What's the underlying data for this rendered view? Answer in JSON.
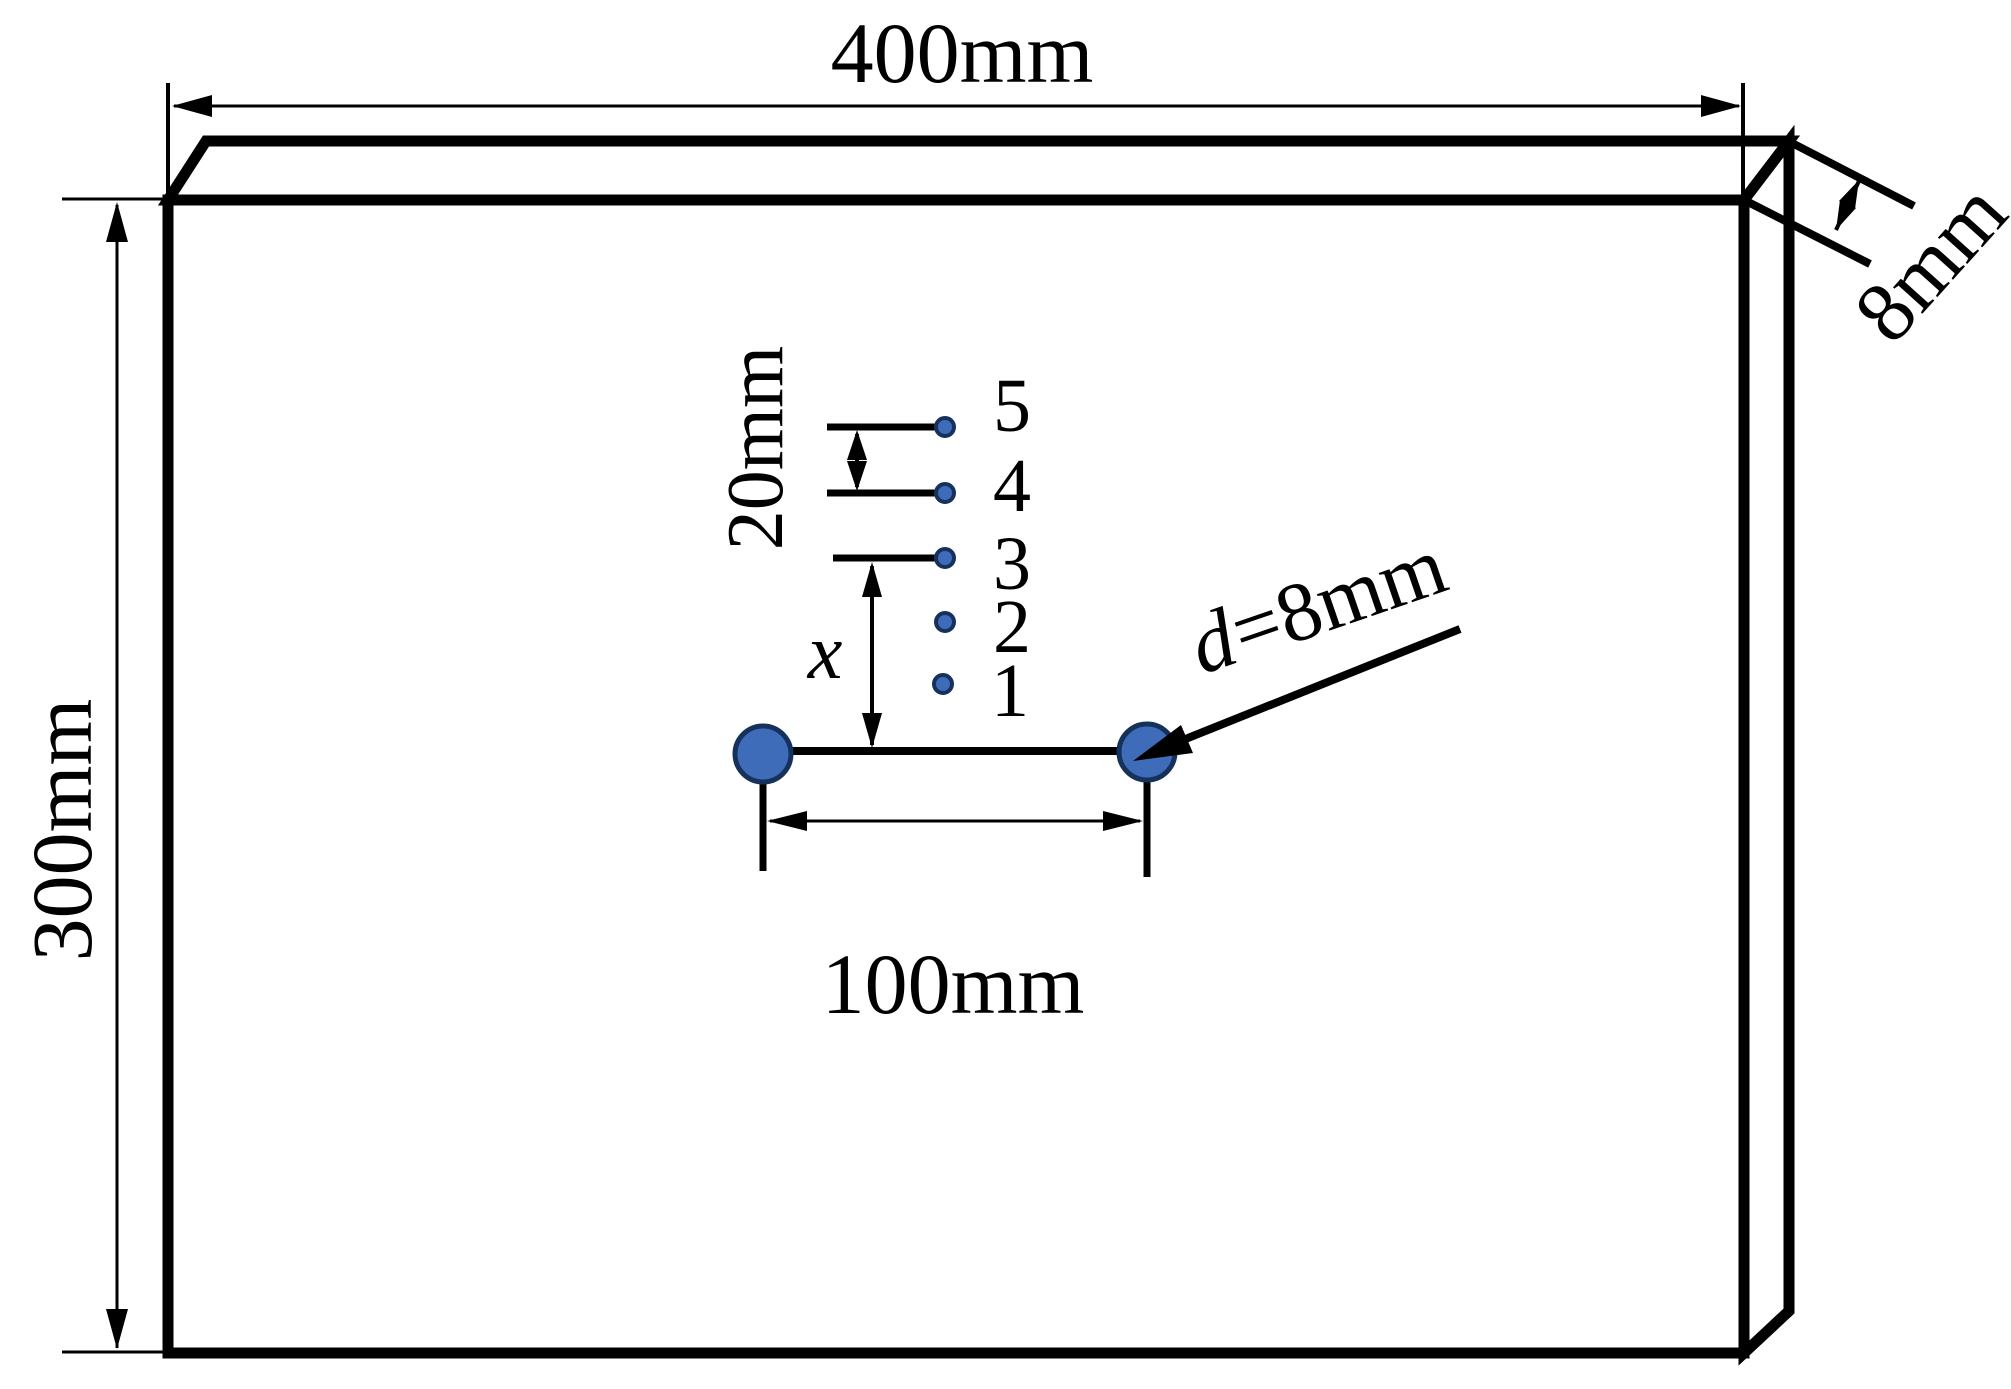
{
  "figure": {
    "plate_width_label": "400mm",
    "plate_height_label": "300mm",
    "plate_thickness_label": "8mm",
    "point_spacing_label": "20mm",
    "point_offset_label": "x",
    "hole_spacing_label": "100mm",
    "hole_diameter_symbol": "d",
    "hole_diameter_value": "=8mm",
    "point_labels": [
      "5",
      "4",
      "3",
      "2",
      "1"
    ]
  },
  "colors": {
    "marker_fill": "#3E6CB9",
    "marker_stroke": "#16325C",
    "line": "#000000",
    "background": "#FFFFFF"
  }
}
